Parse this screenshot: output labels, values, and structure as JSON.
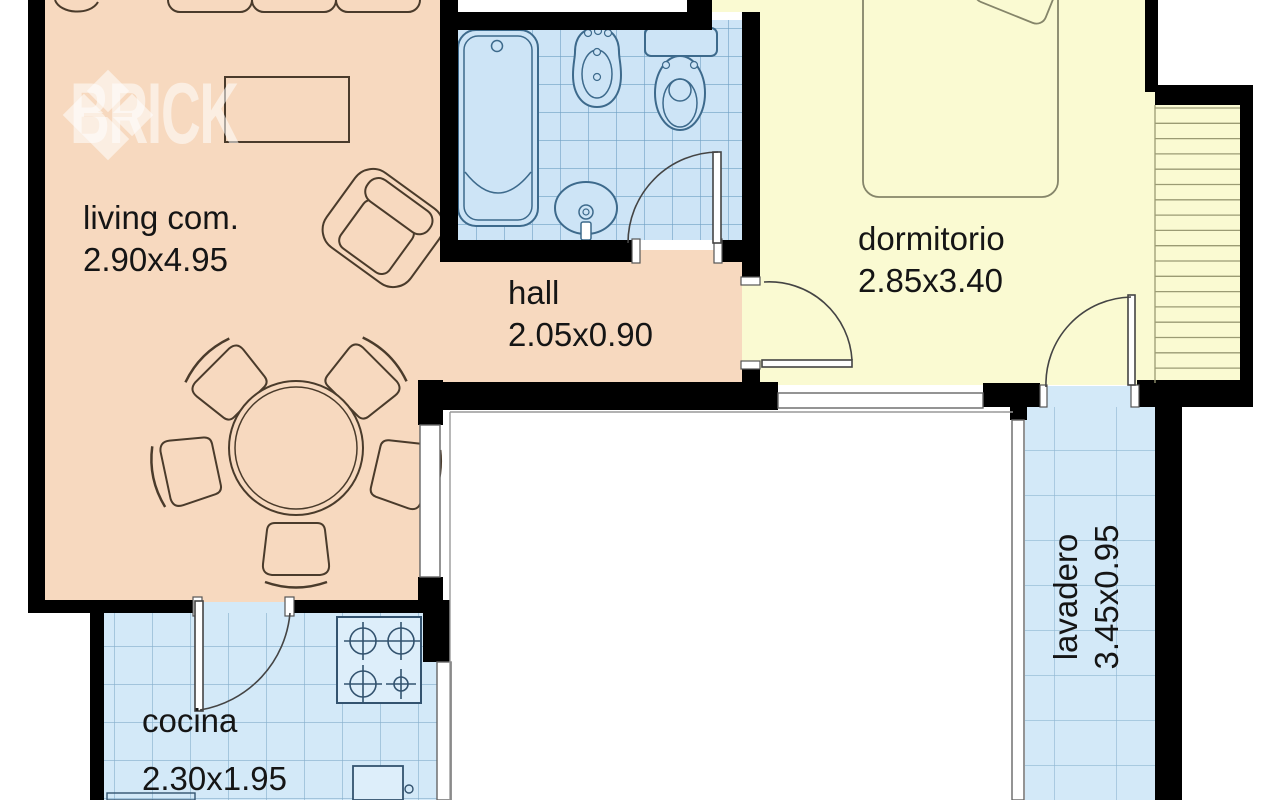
{
  "watermark": {
    "brand": "BRICK"
  },
  "rooms": {
    "living": {
      "label": "living com.",
      "dims": "2.90x4.95",
      "floor_color": "#f7d9bf"
    },
    "hall": {
      "label": "hall",
      "dims": "2.05x0.90",
      "floor_color": "#f7d9bf"
    },
    "dormitorio": {
      "label": "dormitorio",
      "dims": "2.85x3.40",
      "floor_color": "#fafad2"
    },
    "lavadero": {
      "label": "lavadero",
      "dims": "3.45x0.95",
      "floor_color": "#d3e9f8"
    },
    "cocina": {
      "label": "cocina",
      "dims": "2.30x1.95",
      "floor_color": "#d3e9f8"
    }
  },
  "palette": {
    "wall": "#000000",
    "bath_tile": "#cde4f6",
    "bath_tile_line": "#6fa0c4",
    "wet_tile": "#d3e9f8",
    "wet_tile_line": "#8fb6d2",
    "living_line": "#4a3b2b",
    "fixture_line": "#3d6a8c",
    "bed_line": "#85856a",
    "stair_line": "#9b9b74",
    "text": "#151515"
  }
}
